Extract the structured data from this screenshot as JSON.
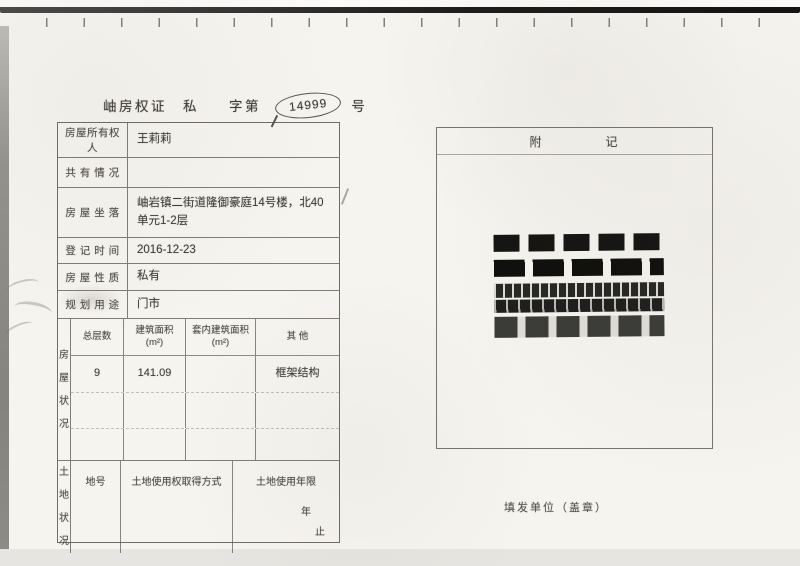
{
  "certificate": {
    "title_prefix": "岫房权证",
    "title_type": "私",
    "title_mid": "字第",
    "serial_number": "14999",
    "title_suffix": "号"
  },
  "form": {
    "rows": [
      {
        "label": "房屋所有权人",
        "value": "王莉莉"
      },
      {
        "label": "共 有 情 况",
        "value": ""
      },
      {
        "label": "房 屋 坐 落",
        "value": "岫岩镇二街道隆御豪庭14号楼，北40单元1-2层"
      },
      {
        "label": "登 记 时 间",
        "value": "2016-12-23"
      },
      {
        "label": "房 屋 性 质",
        "value": "私有"
      },
      {
        "label": "规 划 用 途",
        "value": "门市"
      }
    ],
    "housing_section": {
      "side_label": "房屋状况",
      "columns": [
        "总层数",
        "建筑面积 (m²)",
        "套内建筑面积 (m²)",
        "其  他"
      ],
      "values": [
        "9",
        "141.09",
        "",
        "框架结构"
      ]
    },
    "land_section": {
      "side_label": "土地状况",
      "columns": [
        "地号",
        "土地使用权取得方式",
        "土地使用年限"
      ],
      "year_mark": "年",
      "end_mark": "止"
    }
  },
  "notes_box": {
    "title_left": "附",
    "title_right": "记"
  },
  "footer": {
    "issuer_label": "填发单位（盖章）"
  },
  "colors": {
    "paper": "#f6f4ef",
    "ink": "#45443c",
    "table_border": "#58554c",
    "stamp": "#1c1c1a"
  }
}
